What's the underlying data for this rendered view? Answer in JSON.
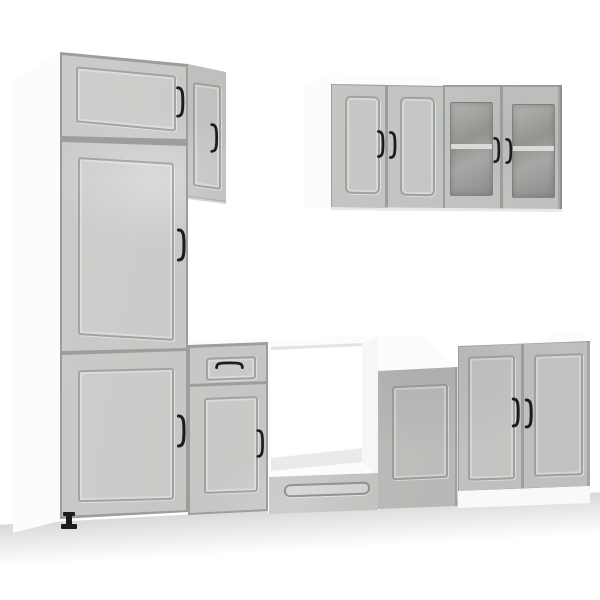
{
  "meta": {
    "type": "product-photo",
    "subject": "8-piece kitchen cabinet furniture set",
    "finish": "concrete grey",
    "setting": "white studio background, no text in image"
  },
  "colors": {
    "background": "#ffffff",
    "cabinet_grey": "#c6c8c5",
    "carcass_dark": "#9b9e9a",
    "white_panel": "#fbfcfb",
    "handle_black": "#1b1d1c",
    "glass_grey": "#94968f",
    "shelf_line": "#dcdedb",
    "floor_shadow": "#8e9390"
  },
  "units": [
    {
      "name": "tall-pantry-cabinet",
      "label": "Tall pantry cabinet with 3 doors",
      "doors": 3,
      "drawers": 0,
      "handles": 3,
      "position": "left"
    },
    {
      "name": "slim-upper-cabinet",
      "label": "Slim upper cabinet with 1 door",
      "doors": 1,
      "drawers": 0,
      "handles": 1,
      "position": "beside tall cabinet"
    },
    {
      "name": "wall-cabinet-solid",
      "label": "Wall cabinet with 2 solid doors",
      "doors": 2,
      "drawers": 0,
      "handles": 2,
      "position": "top right"
    },
    {
      "name": "wall-cabinet-glass",
      "label": "Wall cabinet with 2 frosted glass doors and shelf",
      "doors": 2,
      "drawers": 0,
      "handles": 2,
      "position": "top far right"
    },
    {
      "name": "base-cabinet-drawer",
      "label": "Base cabinet with top drawer and door",
      "doors": 1,
      "drawers": 1,
      "handles": 2,
      "position": "bottom centre-left"
    },
    {
      "name": "oven-housing",
      "label": "Oven housing with open niche and bottom drawer",
      "doors": 0,
      "drawers": 1,
      "handles": 0,
      "position": "bottom centre"
    },
    {
      "name": "base-cabinet-plain",
      "label": "Base cabinet with single door",
      "doors": 1,
      "drawers": 0,
      "handles": 0,
      "position": "bottom centre-right"
    },
    {
      "name": "sink-base-cabinet",
      "label": "Base cabinet with 2 doors",
      "doors": 2,
      "drawers": 0,
      "handles": 2,
      "position": "bottom right"
    }
  ]
}
